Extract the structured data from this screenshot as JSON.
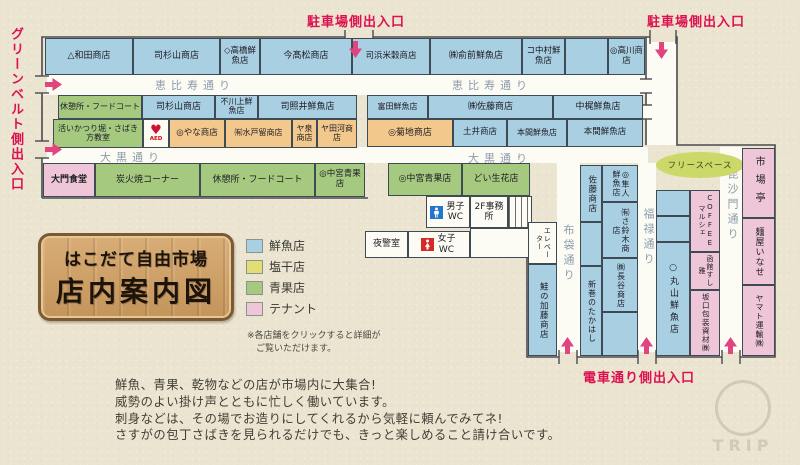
{
  "entrances": {
    "parking_top_left": "駐車場側出入口",
    "parking_top_right": "駐車場側出入口",
    "greenbelt": "グリーンベルト側出入口",
    "tram": "電車通り側出入口"
  },
  "streets": {
    "ebisu_left": "恵比寿通り",
    "ebisu_right": "恵比寿通り",
    "daikoku_left": "大黒通り",
    "daikoku_right": "大黒通り",
    "hotei": "布袋通り",
    "fukuroku": "福禄通り",
    "bishamon": "毘沙門通り",
    "free_space": "フリースペース"
  },
  "shops": {
    "wada": "△和田商店",
    "sugiyama_1": "司杉山商店",
    "takahashi": "◇高橋鮮魚店",
    "takamatsu": "今髙松商店",
    "hamabeikoku": "司浜米穀商店",
    "mae": "㈱俞前鮮魚店",
    "nakamura": "コ中村鮮魚店",
    "takagawa": "◎高川商店",
    "rest_food_court_1": "休憩所・フードコート",
    "sugiyama_2": "司杉山商店",
    "kawakami": "不川上鮮魚店",
    "terui": "司照井鮮魚店",
    "tomita": "富田鮮魚店",
    "sato_kk": "㈱佐藤商店",
    "nakakaji": "中梶鮮魚店",
    "ikatsuri": "活いかつり堀・さばき方教室",
    "yana": "◎やな商店",
    "mitodome": "㈲水戸留商店",
    "izumi": "ヤ泉商店",
    "tagawa": "ヤ田河商店",
    "kikuchi": "◎菊地商店",
    "doi": "土井商店",
    "honma_1": "本間鮮魚店",
    "honma_2": "本間鮮魚店",
    "daimon": "大門食堂",
    "sumibiyaki": "炭火焼コーナー",
    "rest_food_court_2": "休憩所・フードコート",
    "nakamiya_1": "◎中宮青果店",
    "nakamiya_2": "◎中宮青果店",
    "doi_seika": "どい生花店",
    "sake_kato": "鮭の加藤商店",
    "sato_2": "佐藤商店",
    "aramaki": "新巻のたかはし",
    "hayato": "◎隼人鮮魚店",
    "suzuki": "㈲さ鈴木商店",
    "hase": "㈱長谷商店",
    "maruyama": "○丸山鮮魚店",
    "coffee_marche": "COFFEEマルシェ",
    "sushi_masa": "函館すし雅",
    "sakaguchi": "坂口包装資材㈱",
    "ichibatei": "市場亭",
    "menya_inase": "麺屋いなせ",
    "yamato": "ヤマト運輸㈱"
  },
  "facilities": {
    "aed": "AED",
    "mens_wc": "男子WC",
    "office_2f": "2F事務所",
    "night_guard": "夜警室",
    "womens_wc": "女子WC",
    "elevator": "エレベーター"
  },
  "legend": {
    "fresh_fish": "鮮魚店",
    "dried_salted": "塩干店",
    "produce": "青果店",
    "tenant": "テナント"
  },
  "colors": {
    "fresh_fish": "#a9cfe3",
    "dried_salted": "#e3dd76",
    "produce": "#a5c97f",
    "tenant": "#eec6d8",
    "accent_red": "#dd1050"
  },
  "note": {
    "line1": "※各店舗をクリックすると詳細が",
    "line2": "ご覧いただけます。"
  },
  "sign": {
    "line1": "はこだて自由市場",
    "line2": "店内案内図"
  },
  "description": {
    "line1": "鮮魚、青果、乾物などの店が市場内に大集合!",
    "line2": "威勢のよい掛け声とともに忙しく働いています。",
    "line3": "刺身などは、その場でお造りにしてくれるから気軽に頼んでみてネ!",
    "line4": "さすがの包丁さばきを見られるだけでも、きっと楽しめること請け合いです。"
  },
  "watermark": "TRIP"
}
